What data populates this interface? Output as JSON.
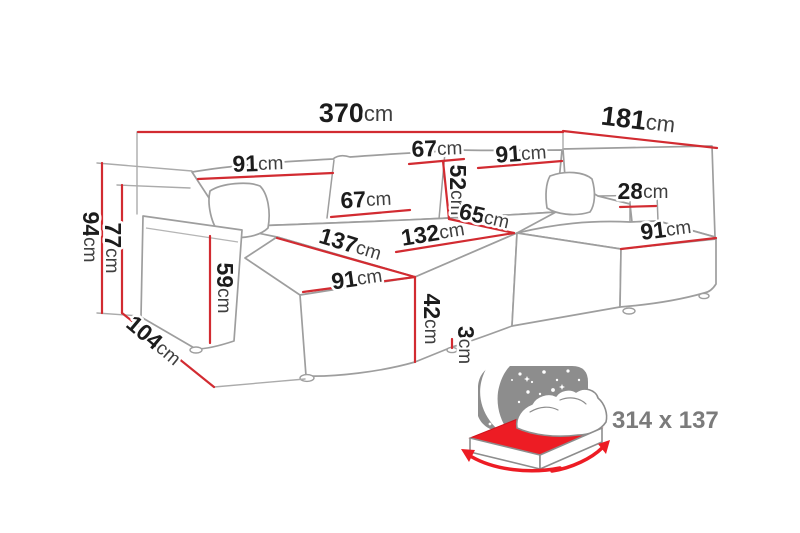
{
  "diagram": {
    "type": "corner-sofa-dimension-diagram",
    "sleeping_area_label": "314 x 137",
    "colors": {
      "dimension_red": "#d22b31",
      "accent_red": "#ed1c24",
      "sofa_outline_gray": "#9e9e9e",
      "label_black": "#1c1c1c",
      "unit_gray": "#3f3f3f",
      "muted_gray": "#7b7b7b",
      "sky_gray": "#8d8d8d"
    },
    "dimensions": [
      {
        "id": "total-width-370",
        "value": "370",
        "unit": "cm",
        "x": 356,
        "y": 115,
        "rot": 0,
        "size": "lg"
      },
      {
        "id": "right-depth-181",
        "value": "181",
        "unit": "cm",
        "x": 638,
        "y": 122,
        "rot": 7,
        "size": "lg"
      },
      {
        "id": "back-left-seat-91",
        "value": "91",
        "unit": "cm",
        "x": 258,
        "y": 165,
        "rot": -2,
        "size": "md"
      },
      {
        "id": "back-top-cushion-67",
        "value": "67",
        "unit": "cm",
        "x": 437,
        "y": 150,
        "rot": -2,
        "size": "md"
      },
      {
        "id": "back-right-seat-91",
        "value": "91",
        "unit": "cm",
        "x": 521,
        "y": 155,
        "rot": -4,
        "size": "md"
      },
      {
        "id": "backrest-height-52",
        "value": "52",
        "unit": "cm",
        "x": 456,
        "y": 190,
        "rot": 90,
        "size": "md"
      },
      {
        "id": "back-cushion-67",
        "value": "67",
        "unit": "cm",
        "x": 366,
        "y": 201,
        "rot": -3,
        "size": "md"
      },
      {
        "id": "corner-seat-65",
        "value": "65",
        "unit": "cm",
        "x": 484,
        "y": 218,
        "rot": 13,
        "size": "md"
      },
      {
        "id": "middle-seat-depth-132",
        "value": "132",
        "unit": "cm",
        "x": 433,
        "y": 235,
        "rot": -9,
        "size": "md"
      },
      {
        "id": "chaise-length-137",
        "value": "137",
        "unit": "cm",
        "x": 350,
        "y": 246,
        "rot": 17,
        "size": "md"
      },
      {
        "id": "chaise-width-91",
        "value": "91",
        "unit": "cm",
        "x": 357,
        "y": 280,
        "rot": -8,
        "size": "md"
      },
      {
        "id": "seat-height-42",
        "value": "42",
        "unit": "cm",
        "x": 430,
        "y": 319,
        "rot": 90,
        "size": "md"
      },
      {
        "id": "leg-height-3",
        "value": "3",
        "unit": "cm",
        "x": 464,
        "y": 345,
        "rot": 90,
        "size": "md"
      },
      {
        "id": "armrest-width-28",
        "value": "28",
        "unit": "cm",
        "x": 643,
        "y": 193,
        "rot": 0,
        "size": "md"
      },
      {
        "id": "right-seat-width-91",
        "value": "91",
        "unit": "cm",
        "x": 666,
        "y": 231,
        "rot": -7,
        "size": "md"
      },
      {
        "id": "total-height-94",
        "value": "94",
        "unit": "cm",
        "x": 89,
        "y": 237,
        "rot": 90,
        "size": "md"
      },
      {
        "id": "armrest-height-77",
        "value": "77",
        "unit": "cm",
        "x": 111,
        "y": 248,
        "rot": 90,
        "size": "md"
      },
      {
        "id": "arm-front-height-59",
        "value": "59",
        "unit": "cm",
        "x": 223,
        "y": 288,
        "rot": 90,
        "size": "md"
      },
      {
        "id": "left-depth-104",
        "value": "104",
        "unit": "cm",
        "x": 153,
        "y": 342,
        "rot": 40,
        "size": "md"
      }
    ]
  }
}
